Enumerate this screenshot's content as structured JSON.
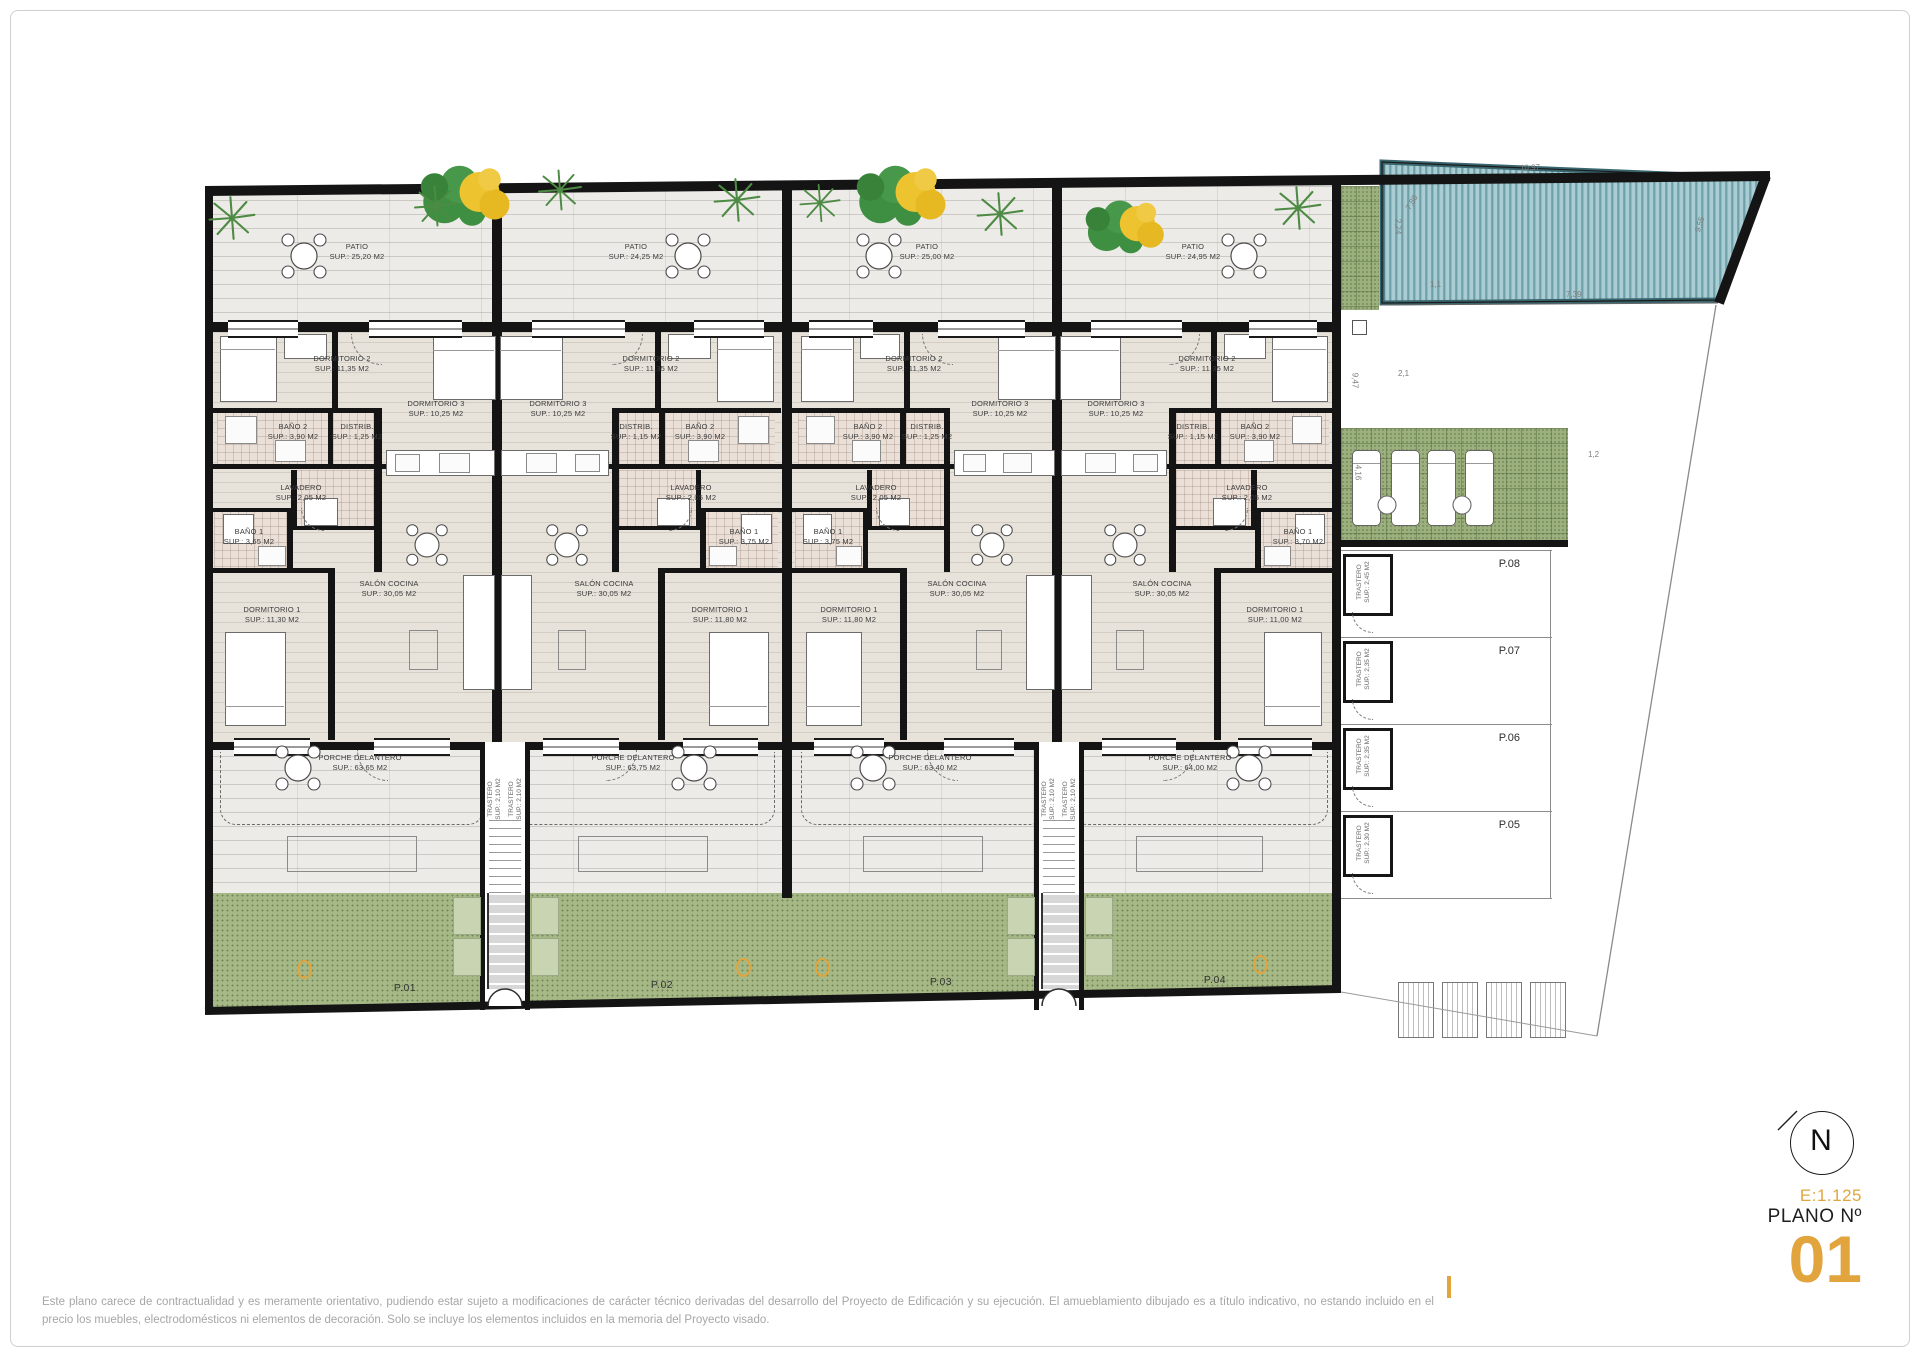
{
  "titleblock": {
    "scale": "E:1.125",
    "plano_label": "PLANO Nº",
    "plano_number": "01",
    "north_letter": "N"
  },
  "disclaimer": "Este plano carece de contractualidad y es meramente orientativo, pudiendo estar sujeto a modificaciones de carácter técnico derivadas del desarrollo del Proyecto de Edificación y su ejecución. El amueblamiento dibujado es a título indicativo, no estando incluido en el precio los muebles, electrodomésticos ni elementos de decoración. Solo se incluye los elementos incluidos en la memoria del Proyecto visado.",
  "units": [
    {
      "plot_label": "P.01",
      "patio": {
        "t": "PATIO",
        "s": "SUP.: 25,20 M2"
      },
      "dorm2": {
        "t": "DORMITORIO 2",
        "s": "SUP.: 11,35 M2"
      },
      "dorm3": {
        "t": "DORMITORIO 3",
        "s": "SUP.: 10,25 M2"
      },
      "bano2": {
        "t": "BAÑO 2",
        "s": "SUP.: 3,90 M2"
      },
      "distrib": {
        "t": "DISTRIB.",
        "s": "SUP.: 1,25 M2"
      },
      "lavadero": {
        "t": "LAVADERO",
        "s": "SUP.: 2,05 M2"
      },
      "bano1": {
        "t": "BAÑO 1",
        "s": "SUP.: 3,65 M2"
      },
      "dorm1": {
        "t": "DORMITORIO 1",
        "s": "SUP.: 11,30 M2"
      },
      "salon": {
        "t": "SALÓN COCINA",
        "s": "SUP.: 30,05 M2"
      },
      "porche": {
        "t": "PORCHE DELANTERO",
        "s": "SUP.: 63,65 M2"
      },
      "trastero": {
        "t": "TRASTERO",
        "s": "SUP.: 2,10 M2"
      }
    },
    {
      "plot_label": "P.02",
      "patio": {
        "t": "PATIO",
        "s": "SUP.: 24,25 M2"
      },
      "dorm2": {
        "t": "DORMITORIO 2",
        "s": "SUP.: 11,35 M2"
      },
      "dorm3": {
        "t": "DORMITORIO 3",
        "s": "SUP.: 10,25 M2"
      },
      "bano2": {
        "t": "BAÑO 2",
        "s": "SUP.: 3,90 M2"
      },
      "distrib": {
        "t": "DISTRIB.",
        "s": "SUP.: 1,15 M2"
      },
      "lavadero": {
        "t": "LAVADERO",
        "s": "SUP.: 2,05 M2"
      },
      "bano1": {
        "t": "BAÑO 1",
        "s": "SUP.: 3,75 M2"
      },
      "dorm1": {
        "t": "DORMITORIO 1",
        "s": "SUP.: 11,80 M2"
      },
      "salon": {
        "t": "SALÓN COCINA",
        "s": "SUP.: 30,05 M2"
      },
      "porche": {
        "t": "PORCHE DELANTERO",
        "s": "SUP.: 63,75 M2"
      },
      "trastero": {
        "t": "TRASTERO",
        "s": "SUP.: 2,10 M2"
      }
    },
    {
      "plot_label": "P.03",
      "patio": {
        "t": "PATIO",
        "s": "SUP.: 25,00 M2"
      },
      "dorm2": {
        "t": "DORMITORIO 2",
        "s": "SUP.: 11,35 M2"
      },
      "dorm3": {
        "t": "DORMITORIO 3",
        "s": "SUP.: 10,25 M2"
      },
      "bano2": {
        "t": "BAÑO 2",
        "s": "SUP.: 3,90 M2"
      },
      "distrib": {
        "t": "DISTRIB.",
        "s": "SUP.: 1,25 M2"
      },
      "lavadero": {
        "t": "LAVADERO",
        "s": "SUP.: 2,05 M2"
      },
      "bano1": {
        "t": "BAÑO 1",
        "s": "SUP.: 3,75 M2"
      },
      "dorm1": {
        "t": "DORMITORIO 1",
        "s": "SUP.: 11,80 M2"
      },
      "salon": {
        "t": "SALÓN COCINA",
        "s": "SUP.: 30,05 M2"
      },
      "porche": {
        "t": "PORCHE DELANTERO",
        "s": "SUP.: 63,40 M2"
      },
      "trastero": {
        "t": "TRASTERO",
        "s": "SUP.: 2,10 M2"
      }
    },
    {
      "plot_label": "P.04",
      "patio": {
        "t": "PATIO",
        "s": "SUP.: 24,95 M2"
      },
      "dorm2": {
        "t": "DORMITORIO 2",
        "s": "SUP.: 11,35 M2"
      },
      "dorm3": {
        "t": "DORMITORIO 3",
        "s": "SUP.: 10,25 M2"
      },
      "bano2": {
        "t": "BAÑO 2",
        "s": "SUP.: 3,90 M2"
      },
      "distrib": {
        "t": "DISTRIB.",
        "s": "SUP.: 1,15 M2"
      },
      "lavadero": {
        "t": "LAVADERO",
        "s": "SUP.: 2,05 M2"
      },
      "bano1": {
        "t": "BAÑO 1",
        "s": "SUP.: 3,70 M2"
      },
      "dorm1": {
        "t": "DORMITORIO 1",
        "s": "SUP.: 11,00 M2"
      },
      "salon": {
        "t": "SALÓN COCINA",
        "s": "SUP.: 30,05 M2"
      },
      "porche": {
        "t": "PORCHE DELANTERO",
        "s": "SUP.: 64,00 M2"
      },
      "trastero": {
        "t": "TRASTERO",
        "s": "SUP.: 2,10 M2"
      }
    }
  ],
  "parking": [
    {
      "label": "P.08",
      "trastero": {
        "t": "TRASTERO",
        "s": "SUP.: 2,45 M2"
      }
    },
    {
      "label": "P.07",
      "trastero": {
        "t": "TRASTERO",
        "s": "SUP.: 2,35 M2"
      }
    },
    {
      "label": "P.06",
      "trastero": {
        "t": "TRASTERO",
        "s": "SUP.: 2,35 M2"
      }
    },
    {
      "label": "P.05",
      "trastero": {
        "t": "TRASTERO",
        "s": "SUP.: 2,30 M2"
      }
    }
  ],
  "dims": [
    "10,97",
    "9,55",
    "2,24",
    "7,88",
    "1,1",
    "7,39",
    "2,1",
    "9,47",
    "4,16",
    "1,2"
  ],
  "colors": {
    "accent": "#e2a43c",
    "wall": "#141414",
    "garden": "#a5b885",
    "pool_light": "#a9cdd2",
    "pool_dark": "#6f9fa8"
  }
}
